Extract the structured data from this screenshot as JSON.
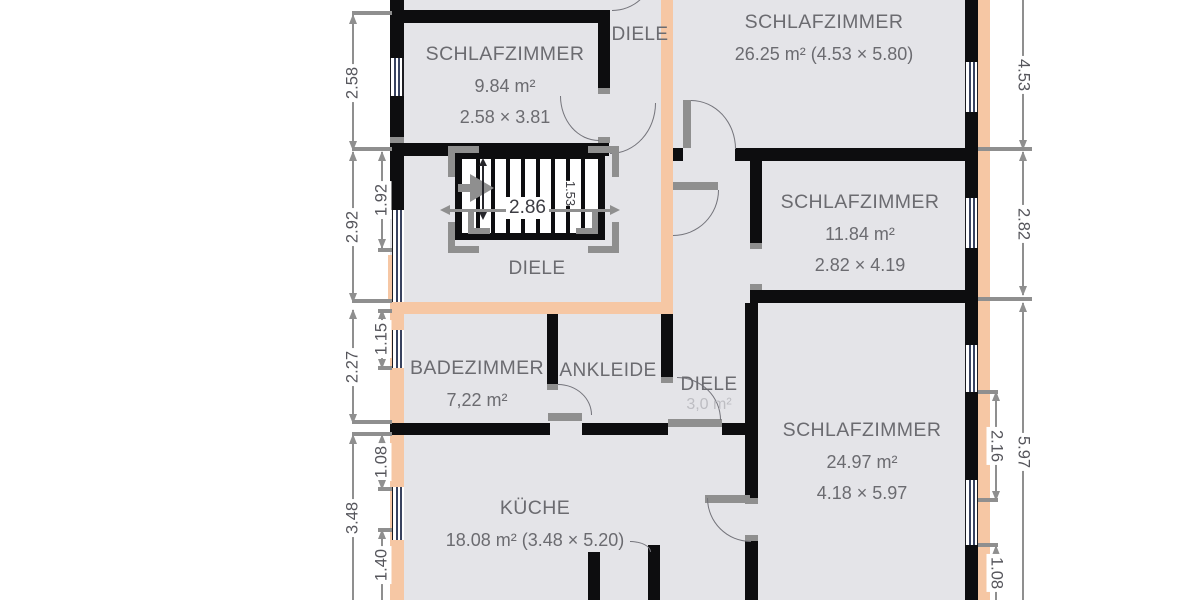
{
  "rooms": [
    {
      "name": "SCHLAFZIMMER",
      "area": "9.84 m²",
      "size": "2.58 × 3.81"
    },
    {
      "name": "DIELE"
    },
    {
      "name": "SCHLAFZIMMER",
      "area": "26.25 m² (4.53 × 5.80)"
    },
    {
      "name": "SCHLAFZIMMER",
      "area": "11.84 m²",
      "size": "2.82 × 4.19"
    },
    {
      "name": "DIELE"
    },
    {
      "name": "BADEZIMMER",
      "area": "7,22 m²"
    },
    {
      "name": "ANKLEIDE"
    },
    {
      "name": "DIELE",
      "area": "3,0 m²"
    },
    {
      "name": "SCHLAFZIMMER",
      "area": "24.97 m²",
      "size": "4.18 × 5.97"
    },
    {
      "name": "KÜCHE",
      "area": "18.08 m² (3.48 × 5.20)"
    }
  ],
  "dimensions": {
    "left_outer": [
      "2.58",
      "2.92",
      "2.27",
      "3.48"
    ],
    "left_inner": [
      "1.92",
      "1.15",
      "1.08",
      "1.40"
    ],
    "right_outer": [
      "4.53",
      "2.82",
      "5.97"
    ],
    "right_inner": [
      "2.16",
      "1.08"
    ],
    "stair_run": "2.86",
    "stair_width": "1.53"
  },
  "colors": {
    "wall": "#0d0d0f",
    "highlight_wall": "#f6c7a4",
    "room_fill": "#e4e4e8",
    "dimension": "#8f8f8f",
    "label": "#6b6b70",
    "window_glazing": "#38425f"
  }
}
